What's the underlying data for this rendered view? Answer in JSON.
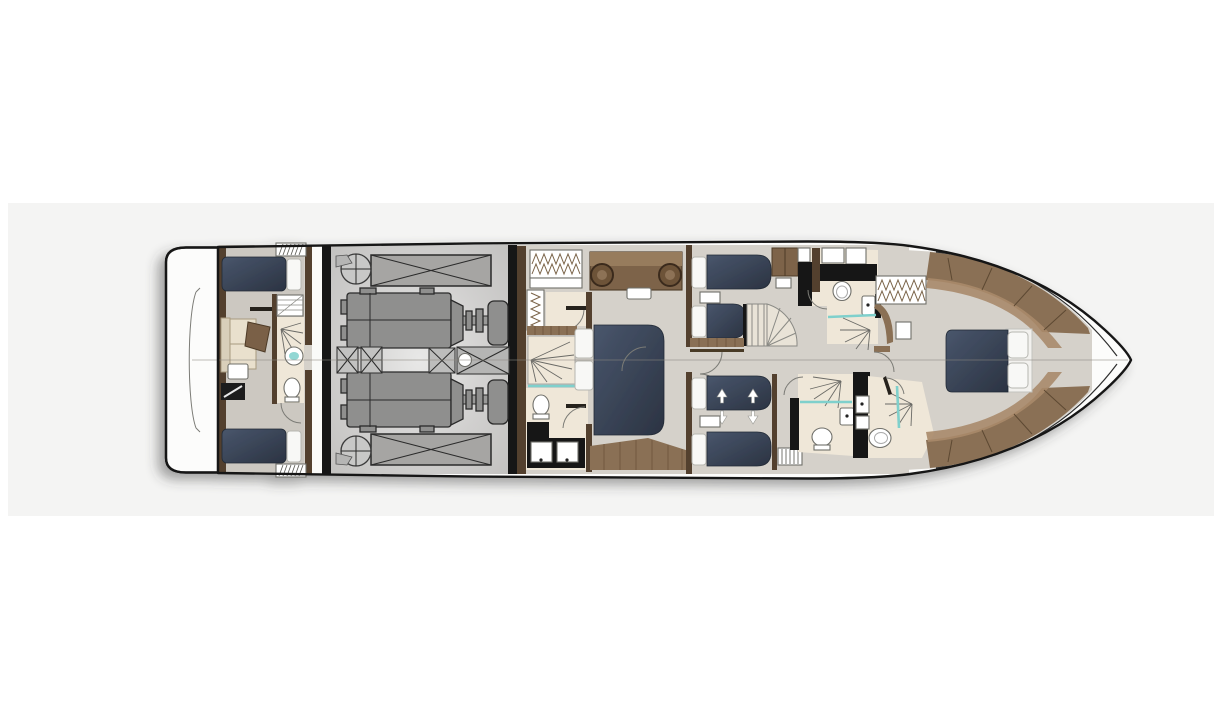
{
  "canvas": {
    "width": 1224,
    "height": 720
  },
  "palette": {
    "page_bg": "#ffffff",
    "panel_bg": "#f4f4f3",
    "hull_fill": "#fcfcfb",
    "hull_stroke": "#151515",
    "floor": "#d5d1ca",
    "floor_crew": "#ccc8c1",
    "machinery": "#8f8f8e",
    "tank": "#a6a5a3",
    "bed_navy_light": "#49566c",
    "bed_navy_dark": "#2b3342",
    "pillow": "#f8f8f6",
    "wood": "#8a7054",
    "wood_light": "#a8896a",
    "wood_dark": "#53402e",
    "wood_deep": "#3a2c1e",
    "bath": "#efe7d8",
    "upholstery": "#e9e0cd",
    "glass": "#7fd0cc",
    "black": "#181818",
    "stair": "#e9e3d7",
    "arc": "#7b7b76",
    "centerline": "#8c8880"
  },
  "diagram": {
    "type": "yacht-lower-deck-floor-plan",
    "orientation": "bow-right",
    "regions": [
      {
        "id": "swim-platform"
      },
      {
        "id": "crew-cabin"
      },
      {
        "id": "crew-bathroom"
      },
      {
        "id": "engine-room"
      },
      {
        "id": "master-bathroom"
      },
      {
        "id": "master-cabin"
      },
      {
        "id": "guest-cabin-starboard"
      },
      {
        "id": "guest-cabin-port"
      },
      {
        "id": "staircase"
      },
      {
        "id": "guest-bathroom-starboard"
      },
      {
        "id": "guest-bathroom-port"
      },
      {
        "id": "vip-bathroom"
      },
      {
        "id": "vip-cabin"
      },
      {
        "id": "bow-deck"
      }
    ],
    "equipment": {
      "engines": 2,
      "fuel_tanks": 2,
      "generator": 1,
      "double_beds": 2,
      "single_beds": 6,
      "toilets": 5,
      "showers": 5
    }
  }
}
